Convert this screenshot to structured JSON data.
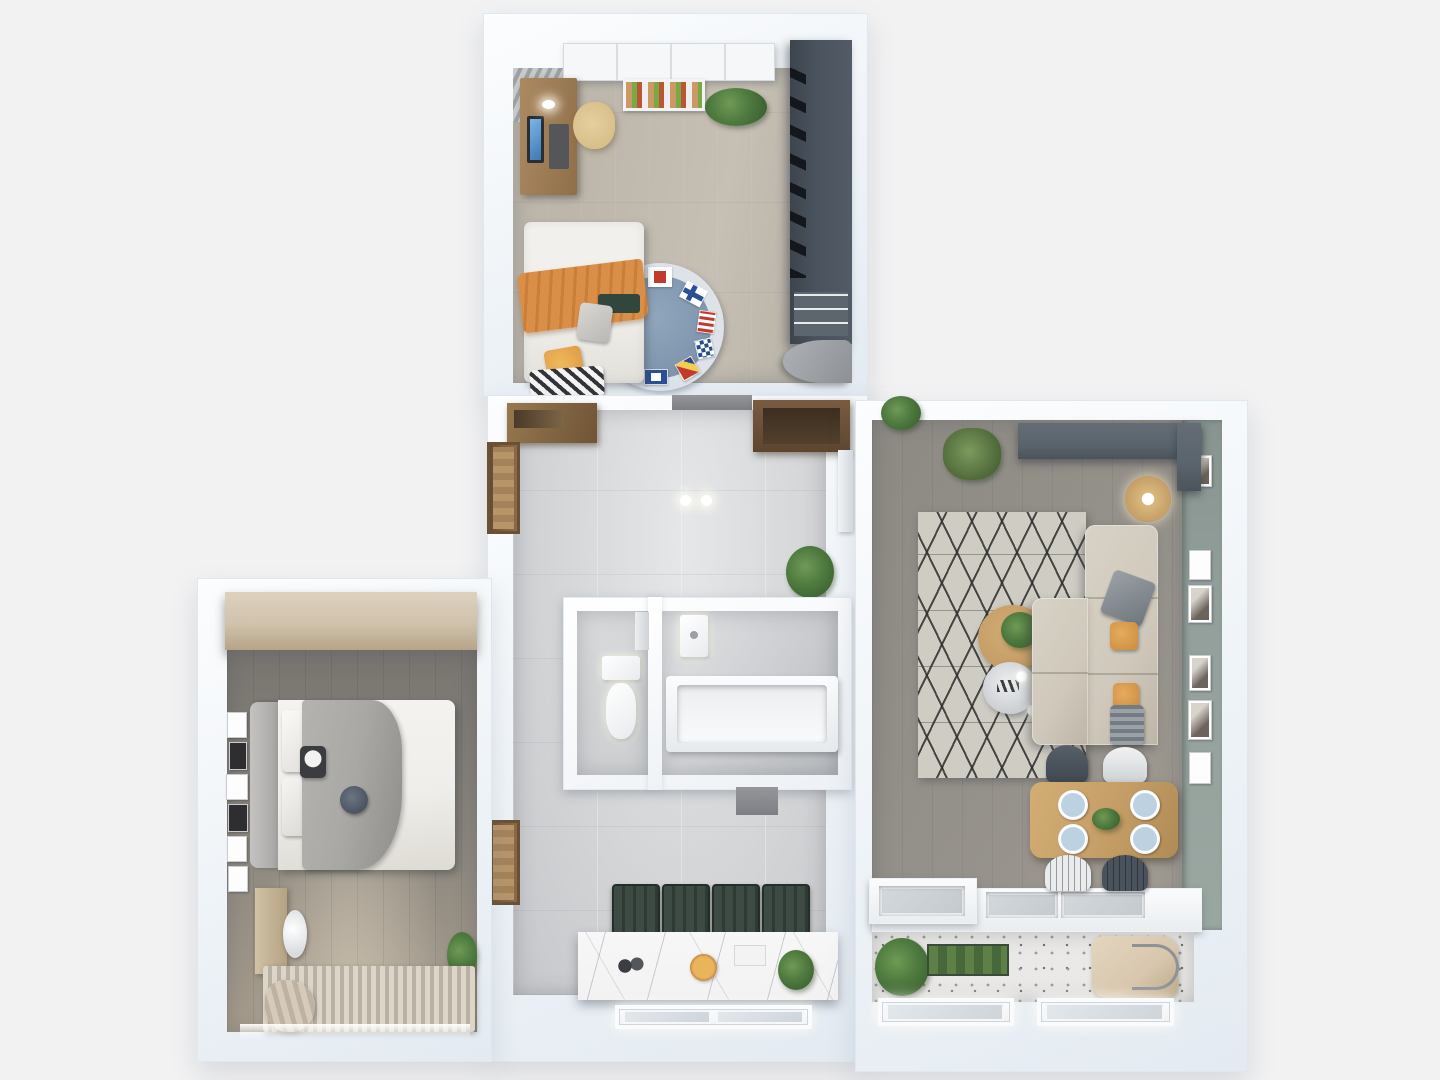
{
  "scene": {
    "type": "3d-floor-plan-top-view",
    "description": "Top-down 3D architectural render of a two-bedroom apartment with kids bedroom, hallway, bathroom and WC, master bedroom, kitchen with marble island, living-dining room and balcony. No text labels are visible in the render."
  },
  "palette": {
    "bg": "#f2f2f3",
    "kidFloor": "#bdb6ab",
    "kidWardrobe": "#4a535d",
    "hallFloor": "#d7d8da",
    "kitchenFloor": "#c6c7ca",
    "bedroomFloor": "#8a857d",
    "bedroomWardrobe": "#d0c2ab",
    "livingFloor": "#94908a",
    "greenWall": "#93a09b",
    "mediaCabinet": "#5a646c",
    "rugCream": "#cfccc4",
    "kidRugBlue": "#7e95ad",
    "kidRugRing": "#dde3e9",
    "orangeBlanket": "#d98f47",
    "orangePillow": "#e2a049",
    "darkGreen": "#31473d",
    "sofa": "#cfc8bb",
    "woodTable": "#c49e66",
    "stoolGreen": "#3e4b44",
    "doorBrown": "#7d5f41",
    "marble": "#f2f2f2",
    "plantGreen": "#4e7a3f",
    "terrazzo": "#eae9e7",
    "wcFloor": "#d0d1d3",
    "blanketGray": "#a9a8a4",
    "bedWhite": "#efeeea",
    "plateBlue": "#bdd2e0",
    "bagTan": "#d8c7ae",
    "chairTan": "#d9c08a"
  },
  "rooms": [
    {
      "id": "kids-bedroom",
      "position": "top-center",
      "furniture": [
        "sliding-door-closet",
        "book-shelf",
        "desk-with-monitor",
        "desk-lamp",
        "tan-desk-chair",
        "potted-plant",
        "dark-open-wardrobe",
        "lounge-chair",
        "single-bed",
        "orange-blanket",
        "chevron-pillow",
        "orange-pillow",
        "round-nautical-flag-rug",
        "corner-curtains"
      ]
    },
    {
      "id": "hallway",
      "position": "center",
      "ceiling_light_count": 2,
      "furniture": [
        "wood-sideboard",
        "entry-door",
        "brown-wardrobe",
        "white-wall-cabinet",
        "potted-plant",
        "ceiling-lights"
      ]
    },
    {
      "id": "wc",
      "position": "center-inner-left",
      "furniture": [
        "toilet",
        "wall-dispenser"
      ]
    },
    {
      "id": "bathroom",
      "position": "center-inner-right",
      "furniture": [
        "sink",
        "bathtub",
        "door-mat"
      ]
    },
    {
      "id": "master-bedroom",
      "position": "left",
      "frame_count": 6,
      "furniture": [
        "wood-wardrobe-beam",
        "double-bed",
        "gray-upholstered-headboard",
        "gray-throw-blanket",
        "panda-pillow",
        "round-pillow",
        "gallery-picture-frames",
        "dresser",
        "round-back-chair",
        "striped-rug",
        "curtain-puddle",
        "potted-plant",
        "window"
      ]
    },
    {
      "id": "kitchen",
      "position": "bottom-center",
      "bar_stool_count": 4,
      "furniture": [
        "marble-island",
        "bar-stools",
        "pizza",
        "bottles",
        "serving-tray",
        "potted-plant",
        "window",
        "bedroom-door"
      ]
    },
    {
      "id": "living-dining-room",
      "position": "right",
      "gallery_frame_count": 6,
      "chandelier_bulb_count": 6,
      "dining_plate_count": 4,
      "dining_chair_count": 4,
      "furniture": [
        "dark-media-cabinet",
        "wall-plant",
        "grass-plant",
        "rattan-floor-lamp",
        "diamond-pattern-rug",
        "round-coffee-table",
        "round-side-table",
        "sputnik-chandelier",
        "corner-sofa",
        "gray-pillow",
        "orange-pillows",
        "striped-pillow",
        "wood-dining-table",
        "plates",
        "dining-chairs",
        "sage-green-wall",
        "picture-frames"
      ]
    },
    {
      "id": "kitchen-counter-balcony",
      "position": "bottom-right",
      "window_count": 2,
      "furniture": [
        "counter-with-sink",
        "cooktop-recesses",
        "herb-plants",
        "planter-box",
        "tote-bag",
        "terrazzo-floor",
        "windows"
      ]
    }
  ]
}
